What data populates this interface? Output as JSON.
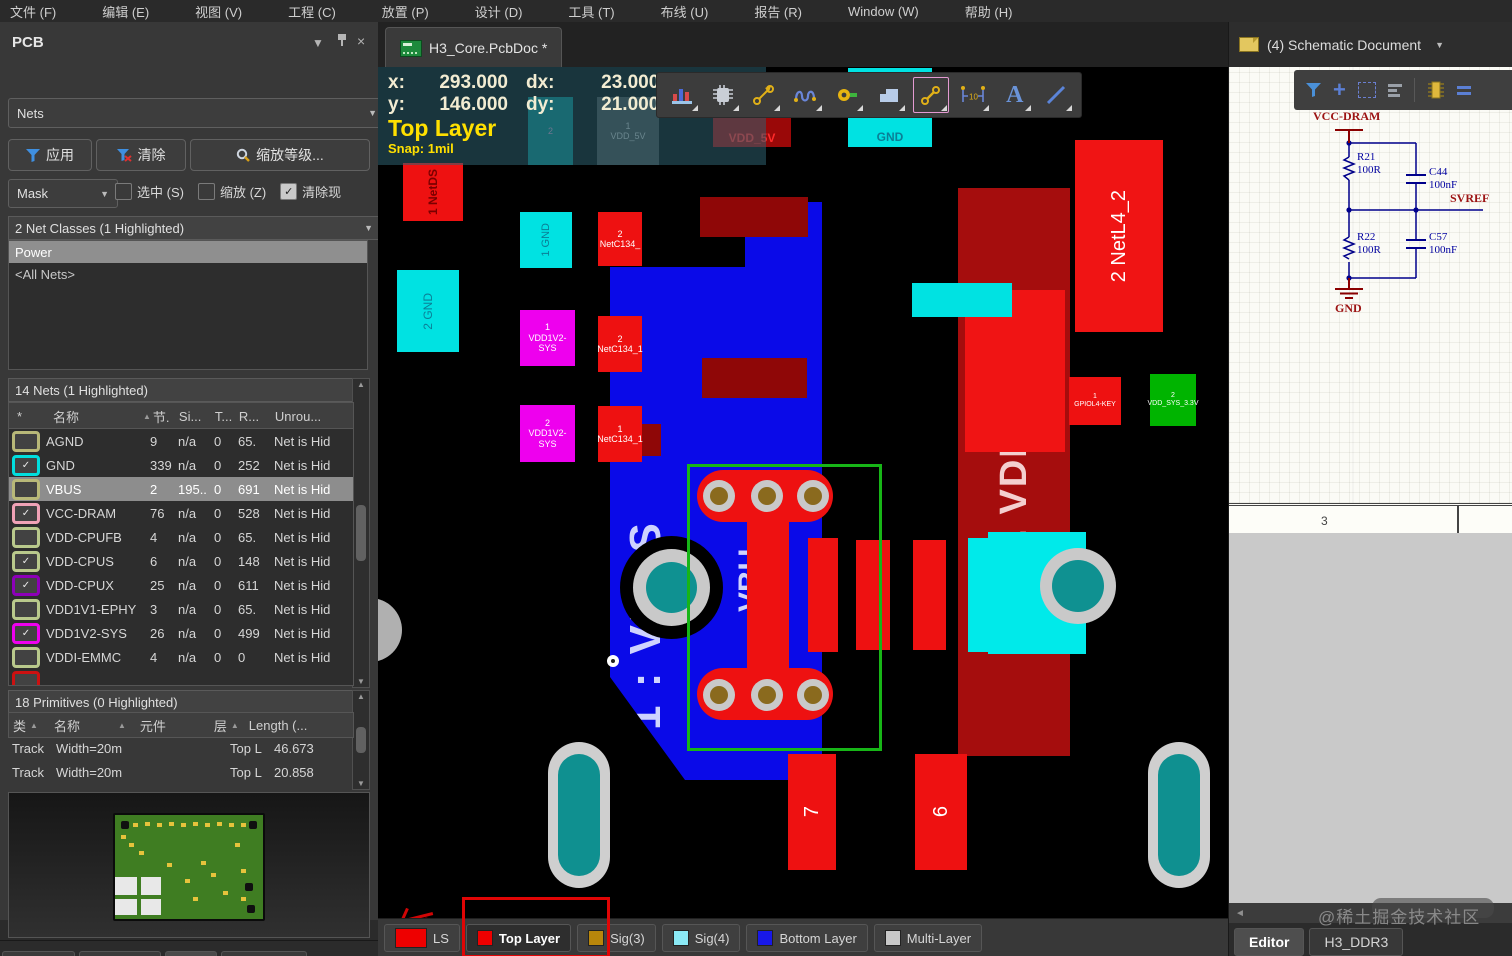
{
  "menu_bar": {
    "items": [
      "文件 (F)",
      "编辑 (E)",
      "视图 (V)",
      "工程 (C)",
      "放置 (P)",
      "设计 (D)",
      "工具 (T)",
      "布线 (U)",
      "报告 (R)",
      "Window (W)",
      "帮助 (H)"
    ]
  },
  "left_panel": {
    "title": "PCB",
    "mode_select": "Nets",
    "buttons": {
      "apply": "应用",
      "clear": "清除",
      "zoom_level": "缩放等级..."
    },
    "mask_select": "Mask",
    "checkboxes": [
      {
        "label": "选中 (S)",
        "checked": false
      },
      {
        "label": "缩放 (Z)",
        "checked": false
      },
      {
        "label": "清除现",
        "checked": true
      }
    ],
    "net_classes": {
      "header": "2 Net Classes (1 Highlighted)",
      "items": [
        {
          "name": "Power",
          "highlighted": true
        },
        {
          "name": "<All Nets>",
          "highlighted": false
        }
      ]
    },
    "nets": {
      "header": "14 Nets (1 Highlighted)",
      "columns": [
        "*",
        "名称",
        "节.",
        "Si...",
        "T...",
        "R...",
        "Unrou..."
      ],
      "rows": [
        {
          "name": "AGND",
          "checked": false,
          "color": "#b8b878",
          "nodes": "9",
          "si": "n/a",
          "t": "0",
          "r": "65.",
          "unrouted": "Net is Hid",
          "selected": false
        },
        {
          "name": "GND",
          "checked": true,
          "color": "#00dede",
          "nodes": "339",
          "si": "n/a",
          "t": "0",
          "r": "252",
          "unrouted": "Net is Hid",
          "selected": false
        },
        {
          "name": "VBUS",
          "checked": false,
          "color": "#b8b878",
          "nodes": "2",
          "si": "195..",
          "t": "0",
          "r": "691",
          "unrouted": "Net is Hid",
          "selected": true
        },
        {
          "name": "VCC-DRAM",
          "checked": true,
          "color": "#f0a2b6",
          "nodes": "76",
          "si": "n/a",
          "t": "0",
          "r": "528",
          "unrouted": "Net is Hid",
          "selected": false
        },
        {
          "name": "VDD-CPUFB",
          "checked": false,
          "color": "#b9c98c",
          "nodes": "4",
          "si": "n/a",
          "t": "0",
          "r": "65.",
          "unrouted": "Net is Hid",
          "selected": false
        },
        {
          "name": "VDD-CPUS",
          "checked": true,
          "color": "#b9c98c",
          "nodes": "6",
          "si": "n/a",
          "t": "0",
          "r": "148",
          "unrouted": "Net is Hid",
          "selected": false
        },
        {
          "name": "VDD-CPUX",
          "checked": true,
          "color": "#8d00b8",
          "nodes": "25",
          "si": "n/a",
          "t": "0",
          "r": "611",
          "unrouted": "Net is Hid",
          "selected": false
        },
        {
          "name": "VDD1V1-EPHY",
          "checked": false,
          "color": "#b9c98c",
          "nodes": "3",
          "si": "n/a",
          "t": "0",
          "r": "65.",
          "unrouted": "Net is Hid",
          "selected": false
        },
        {
          "name": "VDD1V2-SYS",
          "checked": true,
          "color": "#ee00ee",
          "nodes": "26",
          "si": "n/a",
          "t": "0",
          "r": "499",
          "unrouted": "Net is Hid",
          "selected": false
        },
        {
          "name": "VDDI-EMMC",
          "checked": false,
          "color": "#b9c98c",
          "nodes": "4",
          "si": "n/a",
          "t": "0",
          "r": "0",
          "unrouted": "Net is Hid",
          "selected": false
        }
      ]
    },
    "primitives": {
      "header": "18 Primitives (0 Highlighted)",
      "columns": [
        "类",
        "名称",
        "元件",
        "层",
        "Length (..."
      ],
      "rows": [
        {
          "type": "Track",
          "name": "Width=20m",
          "component": "",
          "layer": "Top L",
          "length": "46.673"
        },
        {
          "type": "Track",
          "name": "Width=20m",
          "component": "",
          "layer": "Top L",
          "length": "20.858"
        }
      ]
    },
    "tabs": [
      {
        "label": "Projects",
        "active": false
      },
      {
        "label": "Navigator",
        "active": false
      },
      {
        "label": "PCB",
        "active": true
      },
      {
        "label": "PCB Filter",
        "active": false
      }
    ]
  },
  "document_tab": {
    "title": "H3_Core.PcbDoc *"
  },
  "canvas": {
    "hud": {
      "x_label": "x:",
      "x": "293.000",
      "dx_label": "dx:",
      "dx": "23.000 mil",
      "y_label": "y:",
      "y": "146.000",
      "dy_label": "dy:",
      "dy": "21.000 mil",
      "layer": "Top Layer",
      "snap": "Snap: 1mil"
    },
    "pads": {
      "vdd5v_top": {
        "label": "VDD_5V"
      },
      "gnd_top": {
        "label": "GND"
      },
      "ghost_left": {
        "num": "2"
      },
      "ghost_right": {
        "num": "1",
        "name": "VDD_5V"
      },
      "netds": {
        "label": "1 NetDS"
      },
      "gnd_1": {
        "label": "1 GND"
      },
      "gnd_2": {
        "label": "2 GND"
      },
      "vdd1v2_a": {
        "num": "1",
        "name": "VDD1V2-SYS"
      },
      "vdd1v2_b": {
        "num": "2",
        "name": "VDD1V2-SYS"
      },
      "netc134_a": {
        "num": "2",
        "name": "NetC134_"
      },
      "netc134_b": {
        "num": "2",
        "name": "NetC134_1"
      },
      "netc134_c": {
        "num": "1",
        "name": "NetC134_1"
      },
      "vbus_region": {
        "label": "1 : VBUS",
        "label2": "VBU"
      },
      "vdd5_region": {
        "label": "2. VDD_5"
      },
      "netl4_2": {
        "label": "2 NetL4_2"
      },
      "gpio_key": {
        "num": "1",
        "name": "GPIOL4-KEY"
      },
      "sys_3v3": {
        "num": "2",
        "name": "VDD_SYS_3.3V"
      },
      "pin7": {
        "label": "7"
      },
      "pin6": {
        "label": "6"
      }
    }
  },
  "layer_bar": {
    "tabs": [
      {
        "label": "LS",
        "color": "#ee0000",
        "active": false,
        "big": true
      },
      {
        "label": "Top Layer",
        "color": "#ee0000",
        "active": true,
        "big": false
      },
      {
        "label": "Sig(3)",
        "color": "#b8860b",
        "active": false,
        "big": false
      },
      {
        "label": "Sig(4)",
        "color": "#8ae9f5",
        "active": false,
        "big": false
      },
      {
        "label": "Bottom Layer",
        "color": "#1818e8",
        "active": false,
        "big": false
      },
      {
        "label": "Multi-Layer",
        "color": "#c8c8c8",
        "active": false,
        "big": false
      }
    ]
  },
  "right_panel": {
    "header": "(4) Schematic Document",
    "schematic": {
      "power_net": "VCC-DRAM",
      "r21_ref": "R21",
      "r21_val": "100R",
      "c44_ref": "C44",
      "c44_val": "100nF",
      "svref": "SVREF",
      "r22_ref": "R22",
      "r22_val": "100R",
      "c57_ref": "C57",
      "c57_val": "100nF",
      "gnd": "GND",
      "zone": "3"
    },
    "bottom_tabs": [
      {
        "label": "Editor",
        "active": true
      },
      {
        "label": "H3_DDR3",
        "active": false
      }
    ],
    "watermark": "@稀土掘金技术社区"
  }
}
